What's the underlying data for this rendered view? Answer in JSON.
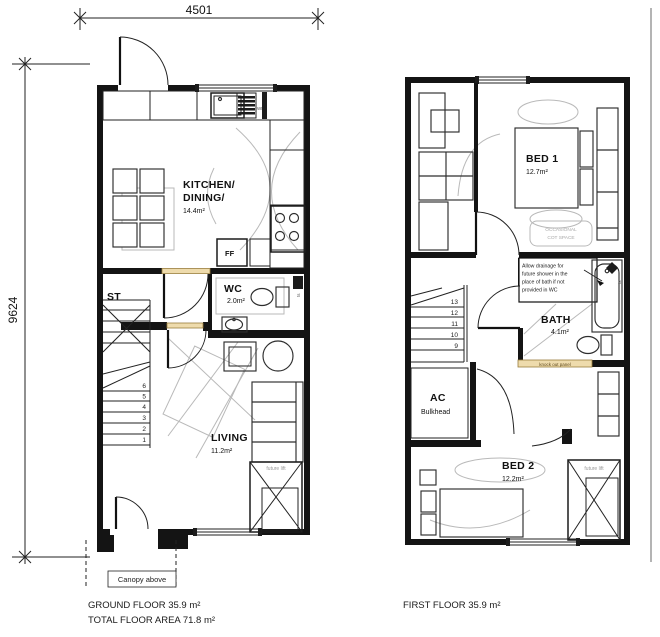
{
  "dimensions": {
    "top": "4501",
    "left": "9624"
  },
  "ground_floor": {
    "kitchen_label1": "KITCHEN/",
    "kitchen_label2": "DINING/",
    "kitchen_area": "14.4m²",
    "wm_label": "WM",
    "ff_label": "FF",
    "st_label": "ST",
    "wc_label": "WC",
    "wc_area": "2.0m²",
    "wc_fixture_tag": "ts",
    "living_label": "LIVING",
    "living_area": "11.2m²",
    "future_lift_label": "future lift",
    "stair_numbers": [
      "6",
      "5",
      "4",
      "3",
      "2",
      "1"
    ],
    "canopy_label": "Canopy above",
    "footer1": "GROUND FLOOR 35.9 m²",
    "footer2": "TOTAL FLOOR AREA 71.8 m²"
  },
  "first_floor": {
    "bed1_label": "BED 1",
    "bed1_area": "12.7m²",
    "cot_line1": "OCCASIONAL",
    "cot_line2": "COT SPACE",
    "note_lines": [
      "Allow drainage for",
      "future shower in the",
      "place of bath if not",
      "provided in WC"
    ],
    "bath_label": "BATH",
    "bath_area": "4.1m²",
    "bath_fixture_tag": "ts",
    "knock_out_label": "knock out panel",
    "stair_numbers": [
      "13",
      "12",
      "11",
      "10",
      "9"
    ],
    "ac_label": "AC",
    "ac_sub_label": "Bulkhead",
    "bed2_label": "BED 2",
    "bed2_area": "12.2m²",
    "future_lift_label": "future lift",
    "footer1": "FIRST FLOOR 35.9 m²"
  },
  "colors": {
    "wall": "#141414",
    "lintel_tan": "#eedbac",
    "ghost_gray": "#b9b9b9",
    "background": "#ffffff"
  }
}
